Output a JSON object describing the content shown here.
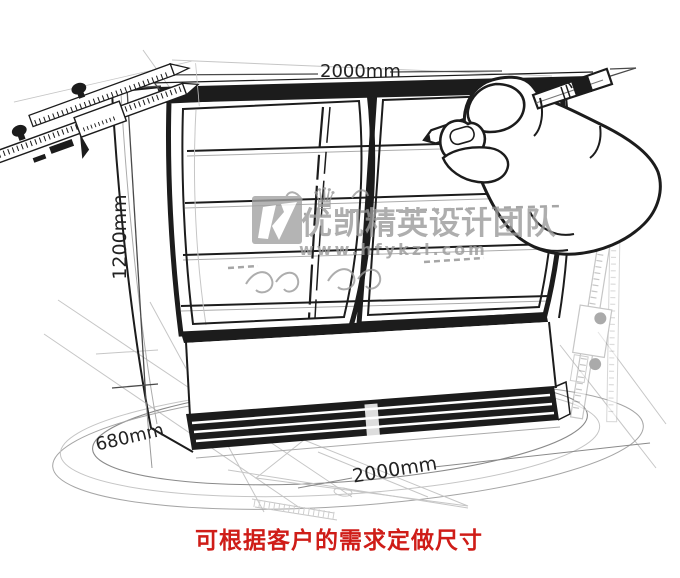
{
  "note": {
    "text": "可根据客户的需求定做尺寸"
  },
  "dimensions": {
    "top_width": "2000mm",
    "height": "1200mm",
    "depth": "680mm",
    "bottom_width": "2000mm"
  },
  "watermark": {
    "crown_glyph": "♛",
    "team_name": "优凯精英设计团队",
    "website": "www.hfykzl.com"
  },
  "colors": {
    "ink": "#1c1c1c",
    "dim_line": "#4a4a4a",
    "sketch_gray": "#9a9a9a",
    "faint_gray": "#c6c6c6",
    "watermark_gray": "#9b9b9b",
    "logo_gray": "#a2a2a2",
    "note_red": "#cf1d18",
    "background": "#ffffff"
  }
}
